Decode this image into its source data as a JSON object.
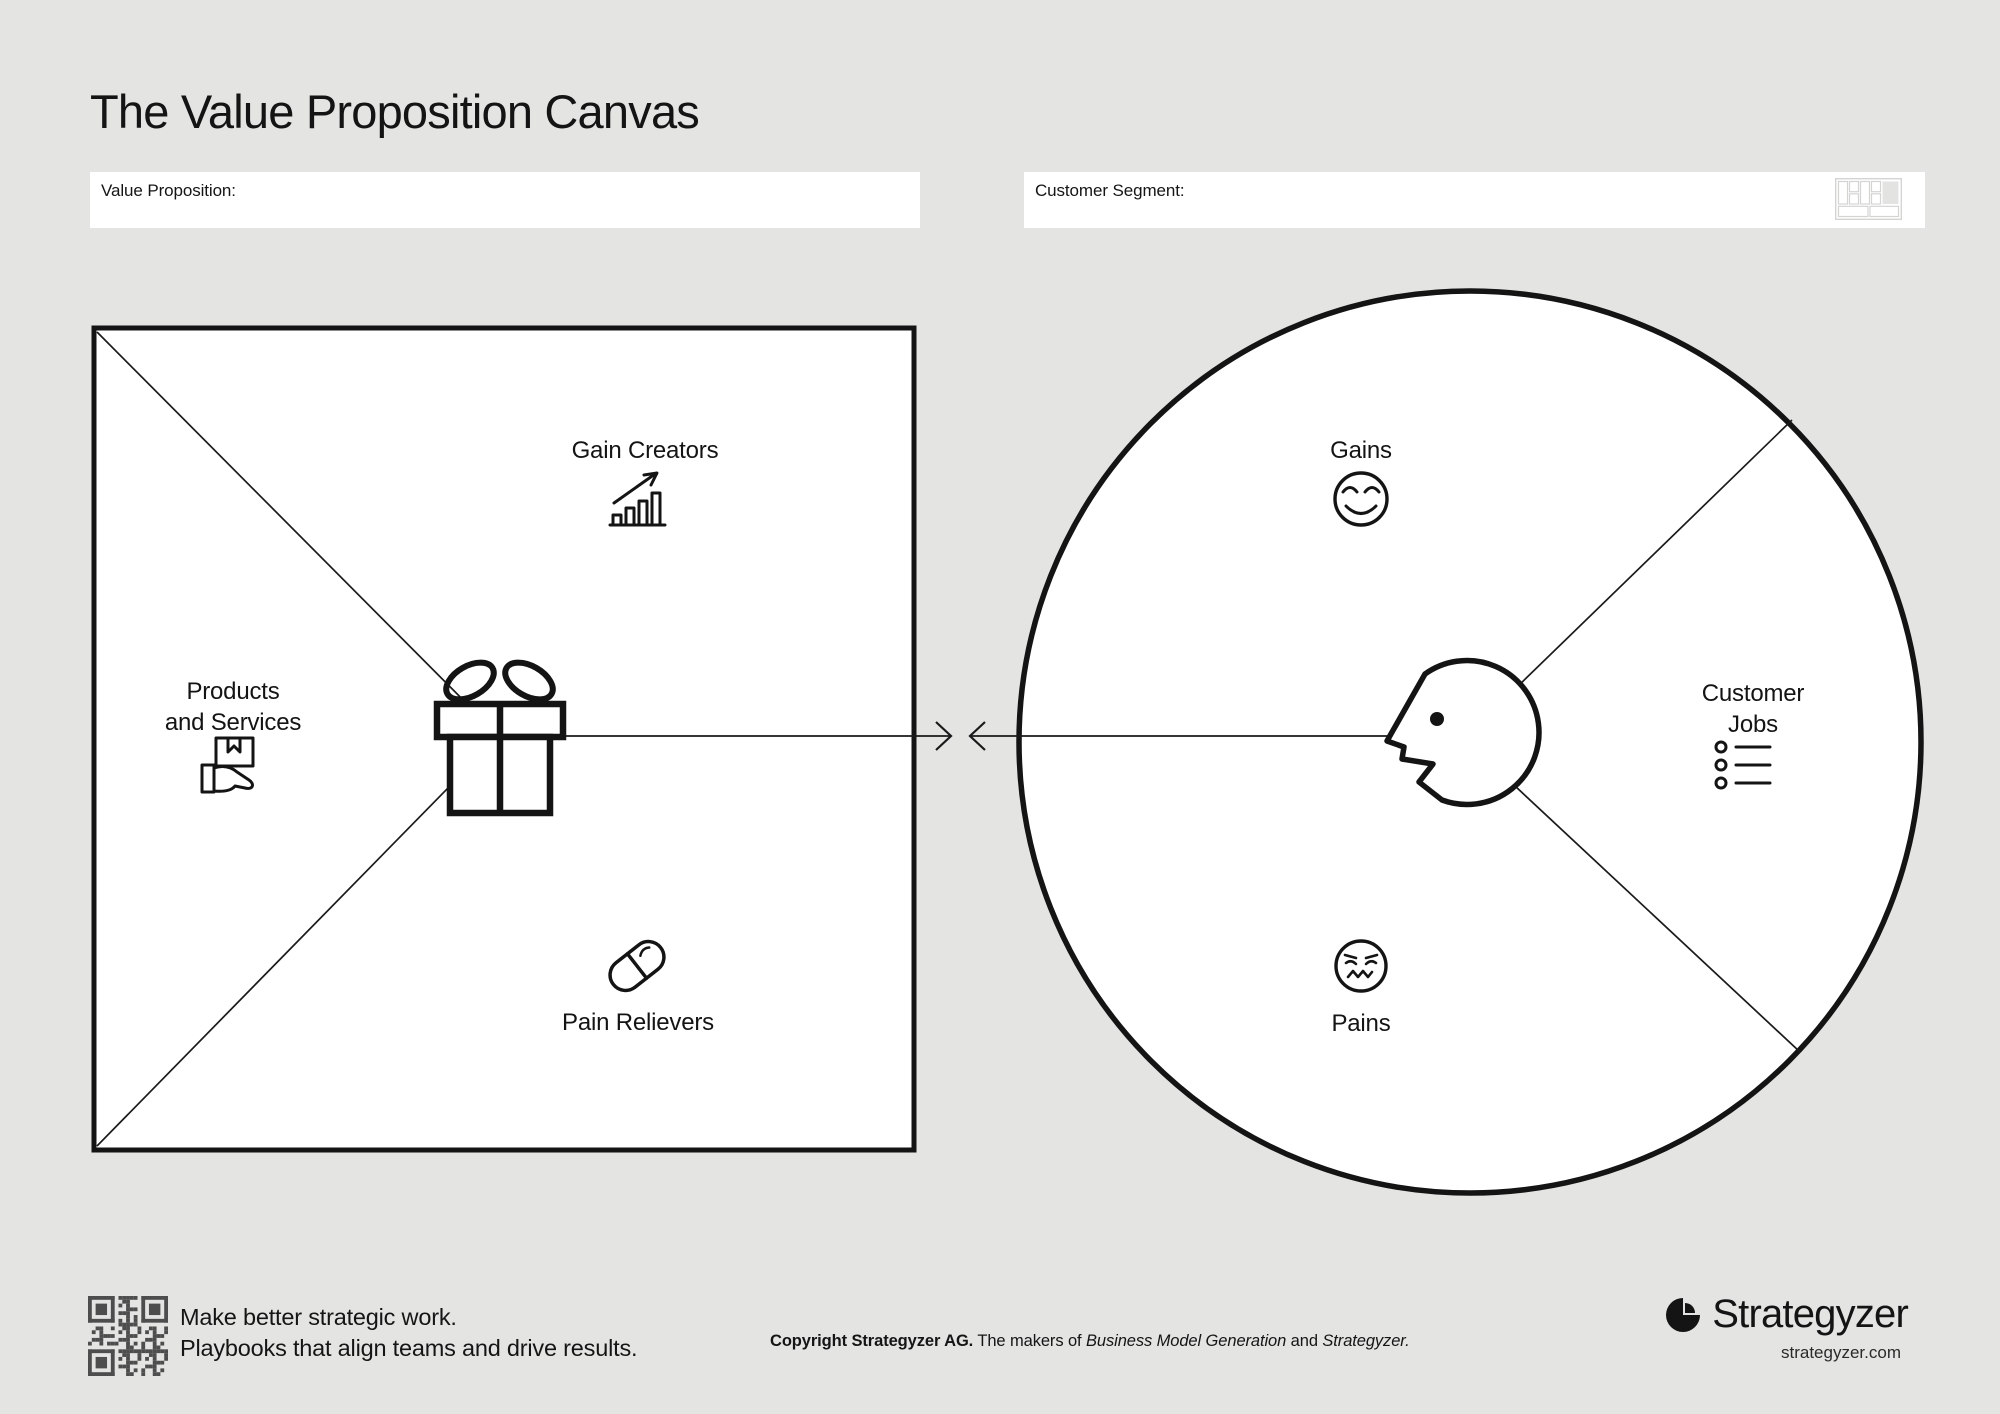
{
  "page": {
    "title": "The Value Proposition Canvas"
  },
  "fields": {
    "value_proposition": {
      "label": "Value Proposition:",
      "value": ""
    },
    "customer_segment": {
      "label": "Customer Segment:",
      "value": ""
    }
  },
  "value_map": {
    "gain_creators": "Gain Creators",
    "products_services_line1": "Products",
    "products_services_line2": "and Services",
    "pain_relievers": "Pain Relievers"
  },
  "customer_profile": {
    "gains": "Gains",
    "customer_jobs_line1": "Customer",
    "customer_jobs_line2": "Jobs",
    "pains": "Pains"
  },
  "footer": {
    "tagline_line1": "Make better strategic work.",
    "tagline_line2": "Playbooks that align teams and drive results.",
    "copyright_bold": "Copyright Strategyzer AG.",
    "copyright_text1": " The makers of ",
    "copyright_italic1": "Business Model Generation",
    "copyright_text2": " and ",
    "copyright_italic2": "Strategyzer.",
    "brand_name": "Strategyzer",
    "brand_url": "strategyzer.com"
  },
  "colors": {
    "ink": "#151515",
    "background": "#e4e4e2",
    "panel": "#ffffff",
    "qr": "#4d4d4d",
    "highlight": "#e3e3e1"
  }
}
